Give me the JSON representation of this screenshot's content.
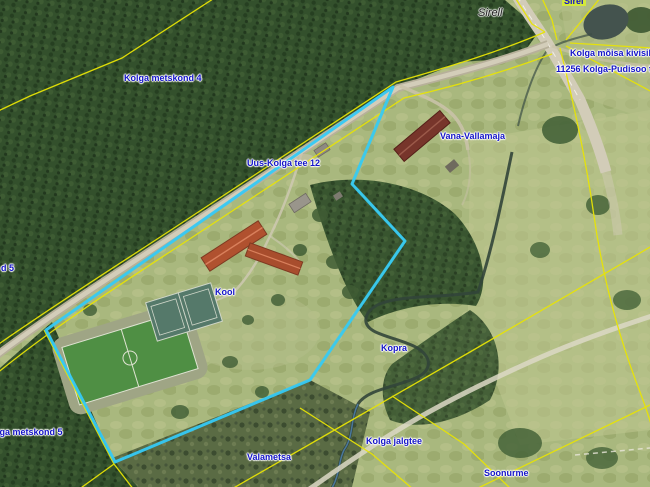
{
  "labels": {
    "sirel_top": "Sirel",
    "sirell_name": "Sirell",
    "kivisild": "Kolga mõisa kivisild",
    "pudisoo_tee": "11256 Kolga-Pudisoo tee",
    "metskond4": "Kolga metskond 4",
    "kolga_tee12": "Uus-Kolga tee 12",
    "vana_vallamaja": "Vana-Vallamaja",
    "kool": "Kool",
    "kopra": "Kopra",
    "jalgtee": "Kolga jalgtee",
    "valametsa": "Valametsa",
    "metskond5": "Kolga metskond 5",
    "edge_cut": "d 5",
    "soonurme": "Soonurme"
  },
  "colors": {
    "parcel_highlight": "#35c9f5",
    "cadastral_line": "#e8e405",
    "label_blue": "#1414c8",
    "label_highlight_bg": "#d3e83a"
  }
}
